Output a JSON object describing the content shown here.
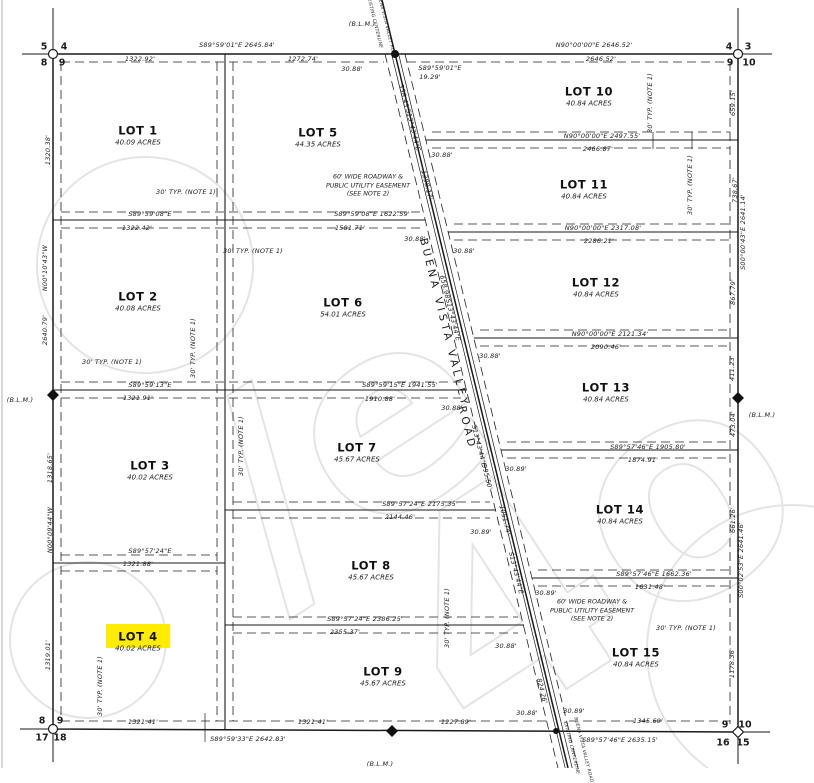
{
  "map": {
    "road_name": "BUENA VISTA VALLEY ROAD",
    "highlight": {
      "lot": "LOT 4",
      "x": 106,
      "y": 624,
      "w": 64,
      "h": 24,
      "color": "#ffec00"
    },
    "colors": {
      "line": "#1a1a1a",
      "watermark": "#e4e4e4",
      "background": "#ffffff",
      "highlight": "#ffec00"
    },
    "lots": [
      {
        "name": "LOT 1",
        "acres": "40.09 ACRES",
        "x": 138,
        "y": 135
      },
      {
        "name": "LOT 2",
        "acres": "40.08 ACRES",
        "x": 138,
        "y": 301
      },
      {
        "name": "LOT 3",
        "acres": "40.02 ACRES",
        "x": 150,
        "y": 470
      },
      {
        "name": "LOT 4",
        "acres": "40.02 ACRES",
        "x": 138,
        "y": 641
      },
      {
        "name": "LOT 5",
        "acres": "44.35 ACRES",
        "x": 318,
        "y": 137
      },
      {
        "name": "LOT 6",
        "acres": "54.01 ACRES",
        "x": 343,
        "y": 307
      },
      {
        "name": "LOT 7",
        "acres": "45.67 ACRES",
        "x": 357,
        "y": 452
      },
      {
        "name": "LOT 8",
        "acres": "45.67 ACRES",
        "x": 371,
        "y": 570
      },
      {
        "name": "LOT 9",
        "acres": "45.67 ACRES",
        "x": 383,
        "y": 676
      },
      {
        "name": "LOT 10",
        "acres": "40.84 ACRES",
        "x": 589,
        "y": 96
      },
      {
        "name": "LOT 11",
        "acres": "40.84 ACRES",
        "x": 584,
        "y": 189
      },
      {
        "name": "LOT 12",
        "acres": "40.84 ACRES",
        "x": 596,
        "y": 287
      },
      {
        "name": "LOT 13",
        "acres": "40.84 ACRES",
        "x": 606,
        "y": 392
      },
      {
        "name": "LOT 14",
        "acres": "40.84 ACRES",
        "x": 620,
        "y": 514
      },
      {
        "name": "LOT 15",
        "acres": "40.84 ACRES",
        "x": 636,
        "y": 657
      }
    ],
    "easement_notes": [
      {
        "x": 368,
        "y": 186,
        "lines": [
          "60' WIDE ROADWAY &",
          "PUBLIC UTILITY EASEMENT",
          "(SEE NOTE 2)"
        ]
      },
      {
        "x": 592,
        "y": 611,
        "lines": [
          "60' WIDE ROADWAY &",
          "PUBLIC UTILITY EASEMENT",
          "(SEE NOTE 2)"
        ]
      }
    ],
    "labels": [
      {
        "t": "(B.L.M.)",
        "x": 362,
        "y": 24
      },
      {
        "t": "(B.L.M.)",
        "x": 20,
        "y": 400
      },
      {
        "t": "(B.L.M.)",
        "x": 762,
        "y": 415
      },
      {
        "t": "(B.L.M.)",
        "x": 380,
        "y": 764
      },
      {
        "t": "S89°59'01\"E  2645.84'",
        "x": 237,
        "y": 45
      },
      {
        "t": "1322.92'",
        "x": 140,
        "y": 59
      },
      {
        "t": "1272.74'",
        "x": 303,
        "y": 59
      },
      {
        "t": "30.88'",
        "x": 352,
        "y": 69
      },
      {
        "t": "S89°59'01\"E",
        "x": 440,
        "y": 68
      },
      {
        "t": "19.29'",
        "x": 430,
        "y": 77
      },
      {
        "t": "N90°00'00\"E  2646.52'",
        "x": 594,
        "y": 45
      },
      {
        "t": "2646.52'",
        "x": 601,
        "y": 59
      },
      {
        "t": "N90°00'00\"E  2497.55'",
        "x": 602,
        "y": 136
      },
      {
        "t": "2466.87'",
        "x": 598,
        "y": 149
      },
      {
        "t": "30.88'",
        "x": 442,
        "y": 155
      },
      {
        "t": "N90°00'00\"E  2317.08'",
        "x": 603,
        "y": 228
      },
      {
        "t": "2286.21'",
        "x": 599,
        "y": 241
      },
      {
        "t": "30.88'",
        "x": 464,
        "y": 251
      },
      {
        "t": "N90°00'00\"E  2121.34'",
        "x": 610,
        "y": 334
      },
      {
        "t": "2090.46'",
        "x": 606,
        "y": 347
      },
      {
        "t": "30.88'",
        "x": 490,
        "y": 356
      },
      {
        "t": "S89°57'46\"E  1905.80'",
        "x": 648,
        "y": 447
      },
      {
        "t": "1874.91'",
        "x": 643,
        "y": 460
      },
      {
        "t": "30.89'",
        "x": 516,
        "y": 469
      },
      {
        "t": "S89°57'46\"E  1662.36'",
        "x": 654,
        "y": 574
      },
      {
        "t": "1631.48'",
        "x": 650,
        "y": 587
      },
      {
        "t": "30.89'",
        "x": 546,
        "y": 593
      },
      {
        "t": "S89°59'08\"E  1622.59'",
        "x": 372,
        "y": 214
      },
      {
        "t": "1581.71'",
        "x": 350,
        "y": 228
      },
      {
        "t": "30.88'",
        "x": 415,
        "y": 239
      },
      {
        "t": "S89°59'15\"E  1941.55'",
        "x": 400,
        "y": 385
      },
      {
        "t": "1910.88'",
        "x": 380,
        "y": 399
      },
      {
        "t": "30.88'",
        "x": 452,
        "y": 408
      },
      {
        "t": "S89°57'24\"E  2175.35'",
        "x": 420,
        "y": 504
      },
      {
        "t": "2144.46'",
        "x": 400,
        "y": 517
      },
      {
        "t": "30.89'",
        "x": 481,
        "y": 532
      },
      {
        "t": "S89°57'24\"E  2386.25'",
        "x": 365,
        "y": 619
      },
      {
        "t": "2355.37'",
        "x": 345,
        "y": 632
      },
      {
        "t": "30.88'",
        "x": 506,
        "y": 646
      },
      {
        "t": "S89°59'08\"E",
        "x": 150,
        "y": 214
      },
      {
        "t": "1322.42'",
        "x": 137,
        "y": 228
      },
      {
        "t": "S89°59'13\"E",
        "x": 150,
        "y": 385
      },
      {
        "t": "1321.91'",
        "x": 138,
        "y": 398
      },
      {
        "t": "S89°57'24\"E",
        "x": 150,
        "y": 551
      },
      {
        "t": "1321.88'",
        "x": 138,
        "y": 564
      },
      {
        "t": "1321.41'",
        "x": 143,
        "y": 722
      },
      {
        "t": "1321.41'",
        "x": 313,
        "y": 722
      },
      {
        "t": "S89°59'33\"E  2642.83'",
        "x": 248,
        "y": 739
      },
      {
        "t": "1227.89'",
        "x": 456,
        "y": 722
      },
      {
        "t": "30.88'",
        "x": 527,
        "y": 713
      },
      {
        "t": "30.89'",
        "x": 574,
        "y": 711
      },
      {
        "t": "S89°57'46\"E  2635.15'",
        "x": 620,
        "y": 740
      },
      {
        "t": "1345.69'",
        "x": 648,
        "y": 721
      },
      {
        "t": "1320.38'",
        "x": 48,
        "y": 150,
        "r": -90
      },
      {
        "t": "N00°10'43\"W",
        "x": 45,
        "y": 268,
        "r": -90
      },
      {
        "t": "2640.79'",
        "x": 45,
        "y": 330,
        "r": -90
      },
      {
        "t": "1318.65'",
        "x": 50,
        "y": 468,
        "r": -90
      },
      {
        "t": "N00°09'44\"W",
        "x": 50,
        "y": 530,
        "r": -90
      },
      {
        "t": "1319.01'",
        "x": 48,
        "y": 655,
        "r": -90
      },
      {
        "t": "659.15'",
        "x": 733,
        "y": 103,
        "r": -90
      },
      {
        "t": "738.67'",
        "x": 735,
        "y": 190,
        "r": -90
      },
      {
        "t": "S00°00'43\"E  2641.14'",
        "x": 743,
        "y": 232,
        "r": -90
      },
      {
        "t": "867.79'",
        "x": 733,
        "y": 292,
        "r": -90
      },
      {
        "t": "411.23'",
        "x": 732,
        "y": 368,
        "r": -90
      },
      {
        "t": "473.04'",
        "x": 733,
        "y": 424,
        "r": -90
      },
      {
        "t": "661.26'",
        "x": 733,
        "y": 520,
        "r": -90
      },
      {
        "t": "S00°02'53\"E  2641.46'",
        "x": 741,
        "y": 560,
        "r": -90
      },
      {
        "t": "1178.36'",
        "x": 732,
        "y": 663,
        "r": -90
      },
      {
        "t": "338.43'",
        "x": 404,
        "y": 97,
        "r": 76
      },
      {
        "t": "S13°43'44\"E",
        "x": 413,
        "y": 130,
        "r": 76
      },
      {
        "t": "1398.17'",
        "x": 427,
        "y": 185,
        "r": 76
      },
      {
        "t": "658.98'",
        "x": 445,
        "y": 288,
        "r": 76
      },
      {
        "t": "S13°43'44\"E",
        "x": 453,
        "y": 320,
        "r": 76
      },
      {
        "t": "S13°43'44\"E",
        "x": 479,
        "y": 446,
        "r": 76
      },
      {
        "t": "995.50'",
        "x": 487,
        "y": 477,
        "r": 76
      },
      {
        "t": "1051.74'",
        "x": 505,
        "y": 520,
        "r": 76
      },
      {
        "t": "S13°43'44\"E",
        "x": 516,
        "y": 573,
        "r": 76
      },
      {
        "t": "824.26'",
        "x": 542,
        "y": 691,
        "r": 76
      },
      {
        "t": "EXISTING CENTERLINE",
        "x": 374,
        "y": 22,
        "r": 76,
        "s": "xs"
      },
      {
        "t": "BUENA VISTA VALLEY ROAD",
        "x": 386,
        "y": 26,
        "r": 76,
        "s": "xs"
      },
      {
        "t": "EXISTING CENTERLINE",
        "x": 571,
        "y": 748,
        "r": 76,
        "s": "xs"
      },
      {
        "t": "BUENA VISTA VALLEY ROAD",
        "x": 583,
        "y": 750,
        "r": 76,
        "s": "xs"
      },
      {
        "t": "BUENA VISTA VALLEY",
        "x": 444,
        "y": 323,
        "r": 76,
        "s": "road"
      },
      {
        "t": "ROAD",
        "x": 467,
        "y": 428,
        "r": 76,
        "s": "road"
      },
      {
        "t": "30' TYP. (NOTE 1)",
        "x": 186,
        "y": 192
      },
      {
        "t": "30' TYP. (NOTE 1)",
        "x": 253,
        "y": 251
      },
      {
        "t": "30' TYP. (NOTE 1)",
        "x": 112,
        "y": 362
      },
      {
        "t": "30' TYP. (NOTE 1)",
        "x": 193,
        "y": 348,
        "r": -90
      },
      {
        "t": "30' TYP. (NOTE 1)",
        "x": 241,
        "y": 446,
        "r": -90
      },
      {
        "t": "30' TYP. (NOTE 1)",
        "x": 100,
        "y": 686,
        "r": -90
      },
      {
        "t": "30' TYP. (NOTE 1)",
        "x": 650,
        "y": 103,
        "r": -90
      },
      {
        "t": "30' TYP. (NOTE 1)",
        "x": 690,
        "y": 185,
        "r": -90
      },
      {
        "t": "30' TYP. (NOTE 1)",
        "x": 686,
        "y": 628
      },
      {
        "t": "30' TYP. (NOTE 1)",
        "x": 447,
        "y": 618,
        "r": -90
      },
      {
        "t": "5",
        "x": 44,
        "y": 47,
        "s": "c"
      },
      {
        "t": "4",
        "x": 64,
        "y": 47,
        "s": "c"
      },
      {
        "t": "8",
        "x": 44,
        "y": 63,
        "s": "c"
      },
      {
        "t": "9",
        "x": 62,
        "y": 63,
        "s": "c"
      },
      {
        "t": "4",
        "x": 729,
        "y": 47,
        "s": "c"
      },
      {
        "t": "3",
        "x": 748,
        "y": 47,
        "s": "c"
      },
      {
        "t": "9",
        "x": 730,
        "y": 63,
        "s": "c"
      },
      {
        "t": "10",
        "x": 749,
        "y": 63,
        "s": "c"
      },
      {
        "t": "8",
        "x": 42,
        "y": 721,
        "s": "c"
      },
      {
        "t": "9",
        "x": 60,
        "y": 721,
        "s": "c"
      },
      {
        "t": "17",
        "x": 42,
        "y": 738,
        "s": "c"
      },
      {
        "t": "18",
        "x": 60,
        "y": 738,
        "s": "c"
      },
      {
        "t": "9",
        "x": 725,
        "y": 725,
        "s": "c"
      },
      {
        "t": "10",
        "x": 745,
        "y": 725,
        "s": "c"
      },
      {
        "t": "16",
        "x": 723,
        "y": 743,
        "s": "c"
      },
      {
        "t": "15",
        "x": 743,
        "y": 743,
        "s": "c"
      }
    ]
  }
}
